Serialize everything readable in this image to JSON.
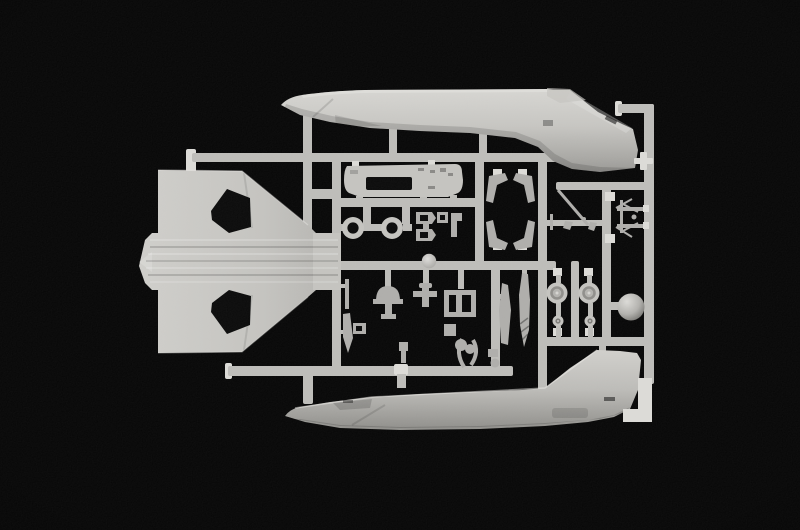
{
  "scene": {
    "type": "photograph",
    "subject": "plastic model kit sprue with light grey aircraft parts on a black background",
    "background": "black"
  },
  "colors": {
    "background": "#020202",
    "runner": "#bdbcb8",
    "runner_bright": "#dcdbd7",
    "plastic": "#c4c3bf",
    "plastic_dim": "#aeadaa",
    "plastic_dark": "#8f8e8a",
    "hole": "#060606"
  },
  "parts": [
    {
      "id": "sprue-frame",
      "label": "sprue runner frame and gates"
    },
    {
      "id": "top-fuselage",
      "label": "fuselage half, top of frame, tail fin sweeping down-right"
    },
    {
      "id": "wing",
      "label": "one-piece delta wing with two dark wheel-well cutouts and slatted center section"
    },
    {
      "id": "bottom-fuselage",
      "label": "fuselage half, bottom of frame, tail fin pointing up"
    },
    {
      "id": "cockpit-floor",
      "label": "cockpit floor insert with rectangular opening"
    },
    {
      "id": "tires",
      "label": "two tire rings"
    },
    {
      "id": "gear-doors",
      "label": "four angled landing-gear-door brackets"
    },
    {
      "id": "pitot-rod",
      "label": "pitot / antenna rod with small gates"
    },
    {
      "id": "gear-leg",
      "label": "spindly landing-gear leg part"
    },
    {
      "id": "seat-parts",
      "label": "ejection seat and cockpit small parts"
    },
    {
      "id": "main-wheels",
      "label": "two main wheels with hub detail"
    },
    {
      "id": "small-wheels",
      "label": "two small nose-gear wheels"
    },
    {
      "id": "sphere",
      "label": "spherical radome / nose weight part"
    },
    {
      "id": "tank-blades",
      "label": "drop tank and fin blade halves"
    },
    {
      "id": "frame-end",
      "label": "bright sprue frame end bracket"
    }
  ]
}
